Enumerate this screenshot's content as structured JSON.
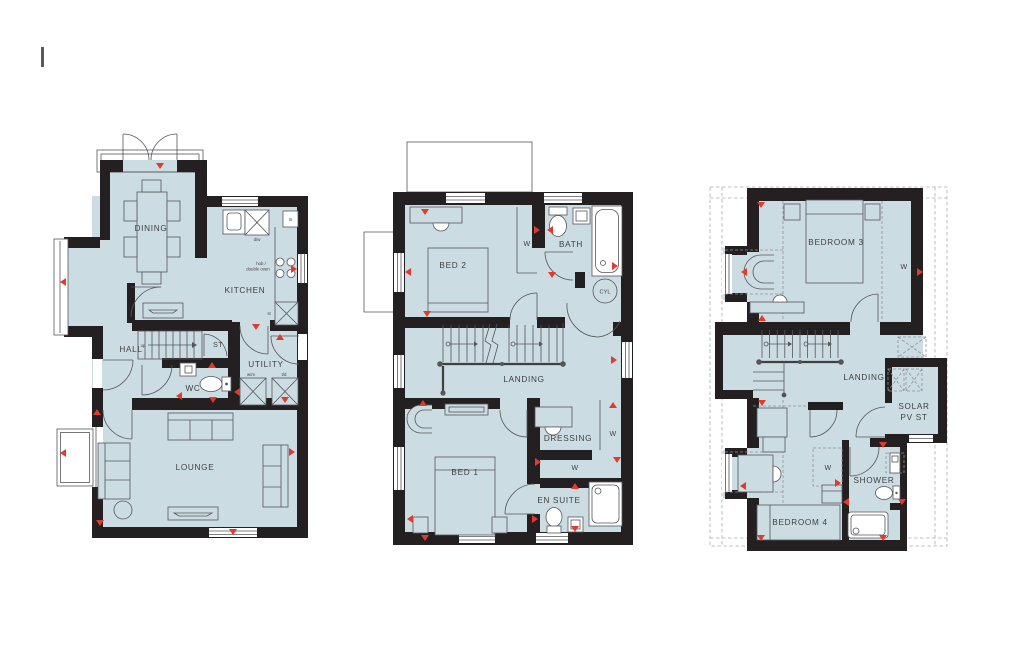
{
  "colors": {
    "floor_fill": "#ccdce3",
    "wall": "#242021",
    "line": "#55565a",
    "arrow_red": "#e23b2e",
    "dashed_roofline": "#aaacae",
    "background": "#ffffff"
  },
  "plans": {
    "ground": {
      "rooms": {
        "dining": "DINING",
        "kitchen": "KITCHEN",
        "hall": "HALL",
        "store": "ST",
        "wc": "WC",
        "utility": "UTILITY",
        "lounge": "LOUNGE"
      },
      "annotations": {
        "dishwasher": "d/w",
        "boiler": "B",
        "hob_line1": "hob /",
        "hob_line2": "double oven",
        "kitchen_store": "st",
        "washing_machine": "w/m",
        "tumble_dryer": "t/d",
        "stairs_up": "up"
      }
    },
    "first": {
      "rooms": {
        "bed2": "BED 2",
        "bath": "BATH",
        "landing": "LANDING",
        "dressing": "DRESSING",
        "bed1": "BED 1",
        "ensuite": "EN SUITE"
      },
      "annotations": {
        "wardrobe_bed2": "W",
        "cylinder": "CYL",
        "wardrobe_dressing": "W",
        "wardrobe_nook": "W"
      }
    },
    "second": {
      "rooms": {
        "bedroom3": "BEDROOM 3",
        "landing": "LANDING",
        "solar_line1": "SOLAR",
        "solar_line2": "PV ST",
        "shower": "SHOWER",
        "bedroom4": "BEDROOM 4"
      },
      "annotations": {
        "wardrobe_bed3": "W",
        "wardrobe_bed4": "W"
      }
    }
  }
}
